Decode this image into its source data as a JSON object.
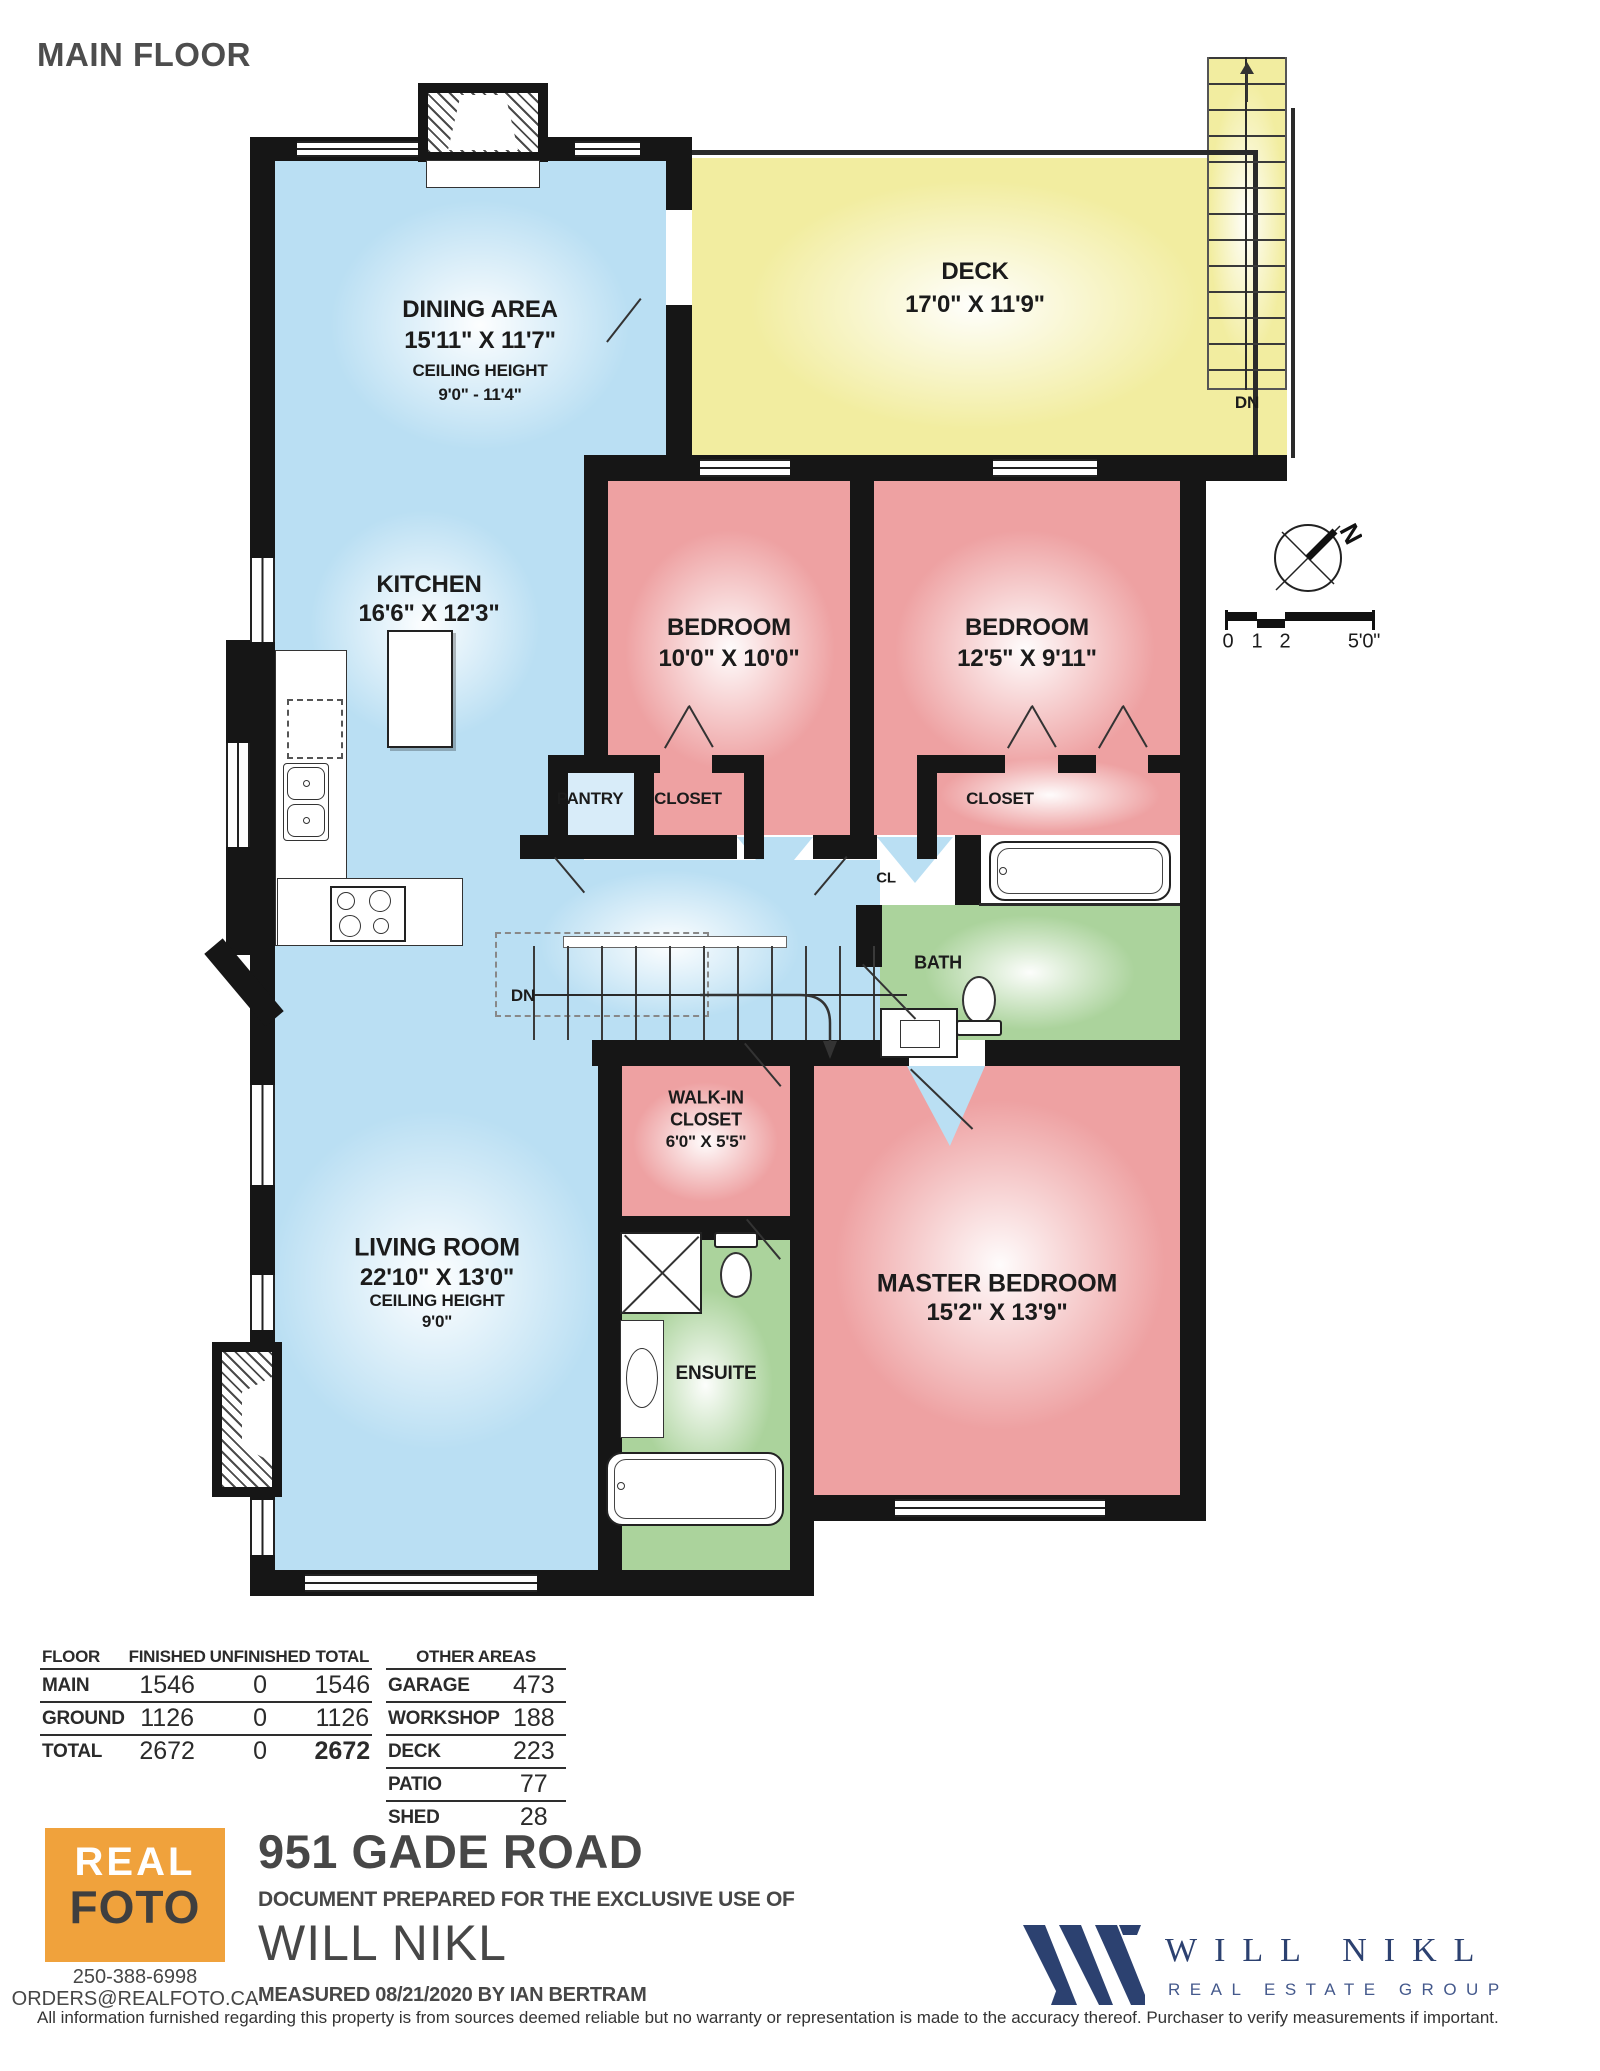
{
  "title": "MAIN FLOOR",
  "colors": {
    "room_blue": "#badff3",
    "room_pink": "#eea1a2",
    "deck_yellow": "#f2eda0",
    "bath_green": "#abd39c",
    "wall": "#161616",
    "logo_orange": "#f0a23c",
    "brand_navy": "#2c4170",
    "text_gray": "#474747"
  },
  "rooms": {
    "dining": {
      "name": "DINING AREA",
      "dims": "15'11\" X 11'7\"",
      "ceiling_label": "CEILING HEIGHT",
      "ceiling_value": "9'0\" - 11'4\""
    },
    "deck": {
      "name": "DECK",
      "dims": "17'0\" X 11'9\"",
      "stairs_down": "DN"
    },
    "kitchen": {
      "name": "KITCHEN",
      "dims": "16'6\" X 12'3\""
    },
    "bedroom1": {
      "name": "BEDROOM",
      "dims": "10'0\" X 10'0\""
    },
    "bedroom2": {
      "name": "BEDROOM",
      "dims": "12'5\" X 9'11\""
    },
    "pantry": {
      "name": "PANTRY"
    },
    "closet1": {
      "name": "CLOSET"
    },
    "closet2": {
      "name": "CLOSET"
    },
    "cl": {
      "name": "CL"
    },
    "bath": {
      "name": "BATH"
    },
    "stairs": {
      "down_label": "DN"
    },
    "walk_in": {
      "line1": "WALK-IN",
      "line2": "CLOSET",
      "dims": "6'0\" X 5'5\""
    },
    "master": {
      "name": "MASTER BEDROOM",
      "dims": "15'2\" X 13'9\""
    },
    "ensuite": {
      "name": "ENSUITE"
    },
    "living": {
      "name": "LIVING ROOM",
      "dims": "22'10\" X 13'0\"",
      "ceiling_label": "CEILING HEIGHT",
      "ceiling_value": "9'0\""
    }
  },
  "compass": {
    "north": "N"
  },
  "scale": {
    "t0": "0",
    "t1": "1",
    "t2": "2",
    "t3": "5'0\""
  },
  "area_table": {
    "headers": [
      "FLOOR",
      "FINISHED",
      "UNFINISHED",
      "TOTAL"
    ],
    "rows": [
      [
        "MAIN",
        "1546",
        "0",
        "1546"
      ],
      [
        "GROUND",
        "1126",
        "0",
        "1126"
      ],
      [
        "TOTAL",
        "2672",
        "0",
        "2672"
      ]
    ]
  },
  "other_areas": {
    "title": "OTHER AREAS",
    "rows": [
      [
        "GARAGE",
        "473"
      ],
      [
        "WORKSHOP",
        "188"
      ],
      [
        "DECK",
        "223"
      ],
      [
        "PATIO",
        "77"
      ],
      [
        "SHED",
        "28"
      ]
    ]
  },
  "footer": {
    "logo_top": "REAL",
    "logo_bottom": "FOTO",
    "phone": "250-388-6998",
    "email": "ORDERS@REALFOTO.CA",
    "address": "951 GADE ROAD",
    "prepared": "DOCUMENT PREPARED FOR THE EXCLUSIVE USE OF",
    "client": "WILL NIKL",
    "measured": "MEASURED 08/21/2020  BY IAN BERTRAM",
    "disclaimer": "All information furnished regarding this property is from sources deemed reliable but no warranty or representation is made to the accuracy thereof. Purchaser to verify measurements if important.",
    "brand_name": "WILL NIKL",
    "brand_tagline": "REAL ESTATE GROUP"
  }
}
